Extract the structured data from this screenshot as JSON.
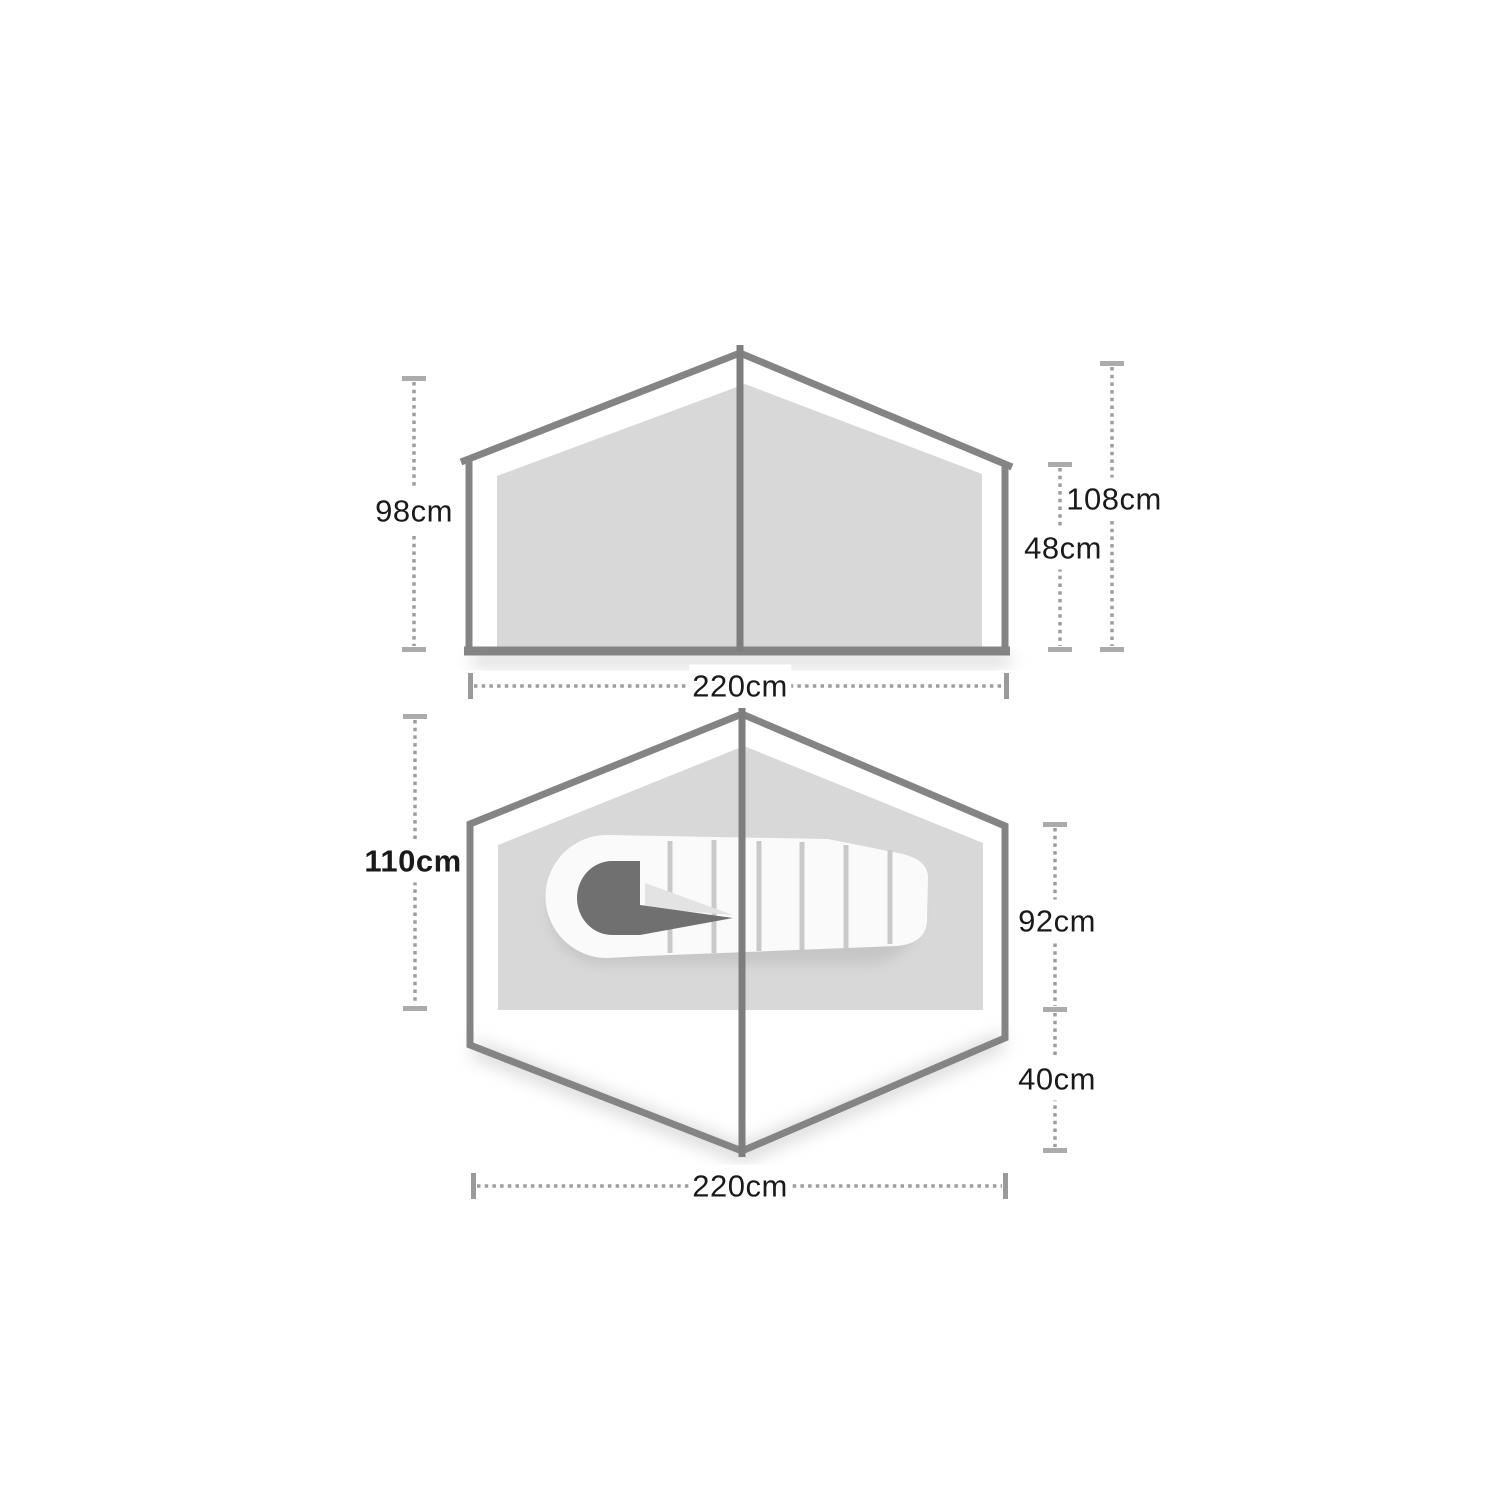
{
  "diagram_title": "tent-dimensions-diagram",
  "side_view": {
    "name": "side elevation",
    "labels": {
      "left": "98cm",
      "right_outer": "108cm",
      "right_inner": "48cm",
      "bottom": "220cm"
    }
  },
  "floor_plan": {
    "name": "floor plan",
    "labels": {
      "left": "110cm",
      "right_top": "92cm",
      "right_bottom": "40cm",
      "bottom": "220cm"
    }
  },
  "colors": {
    "background": "#ffffff",
    "outline": "#848484",
    "pole": "#7e7e7e",
    "panel_fill": "#d8d8d8",
    "dimension_dots": "#9d9d9d",
    "dimension_caps_horizontal": "#ababab",
    "dimension_caps_vertical": "#9a9a9a",
    "label_text": "#1a1a1a",
    "sleeping_bag": "#fafafa",
    "sleeping_bag_baffles": "#c9c9c9",
    "sleeping_bag_hood": "#707070",
    "sleeping_bag_flap": "#e3e3e3",
    "shadow": "#cccccc"
  }
}
